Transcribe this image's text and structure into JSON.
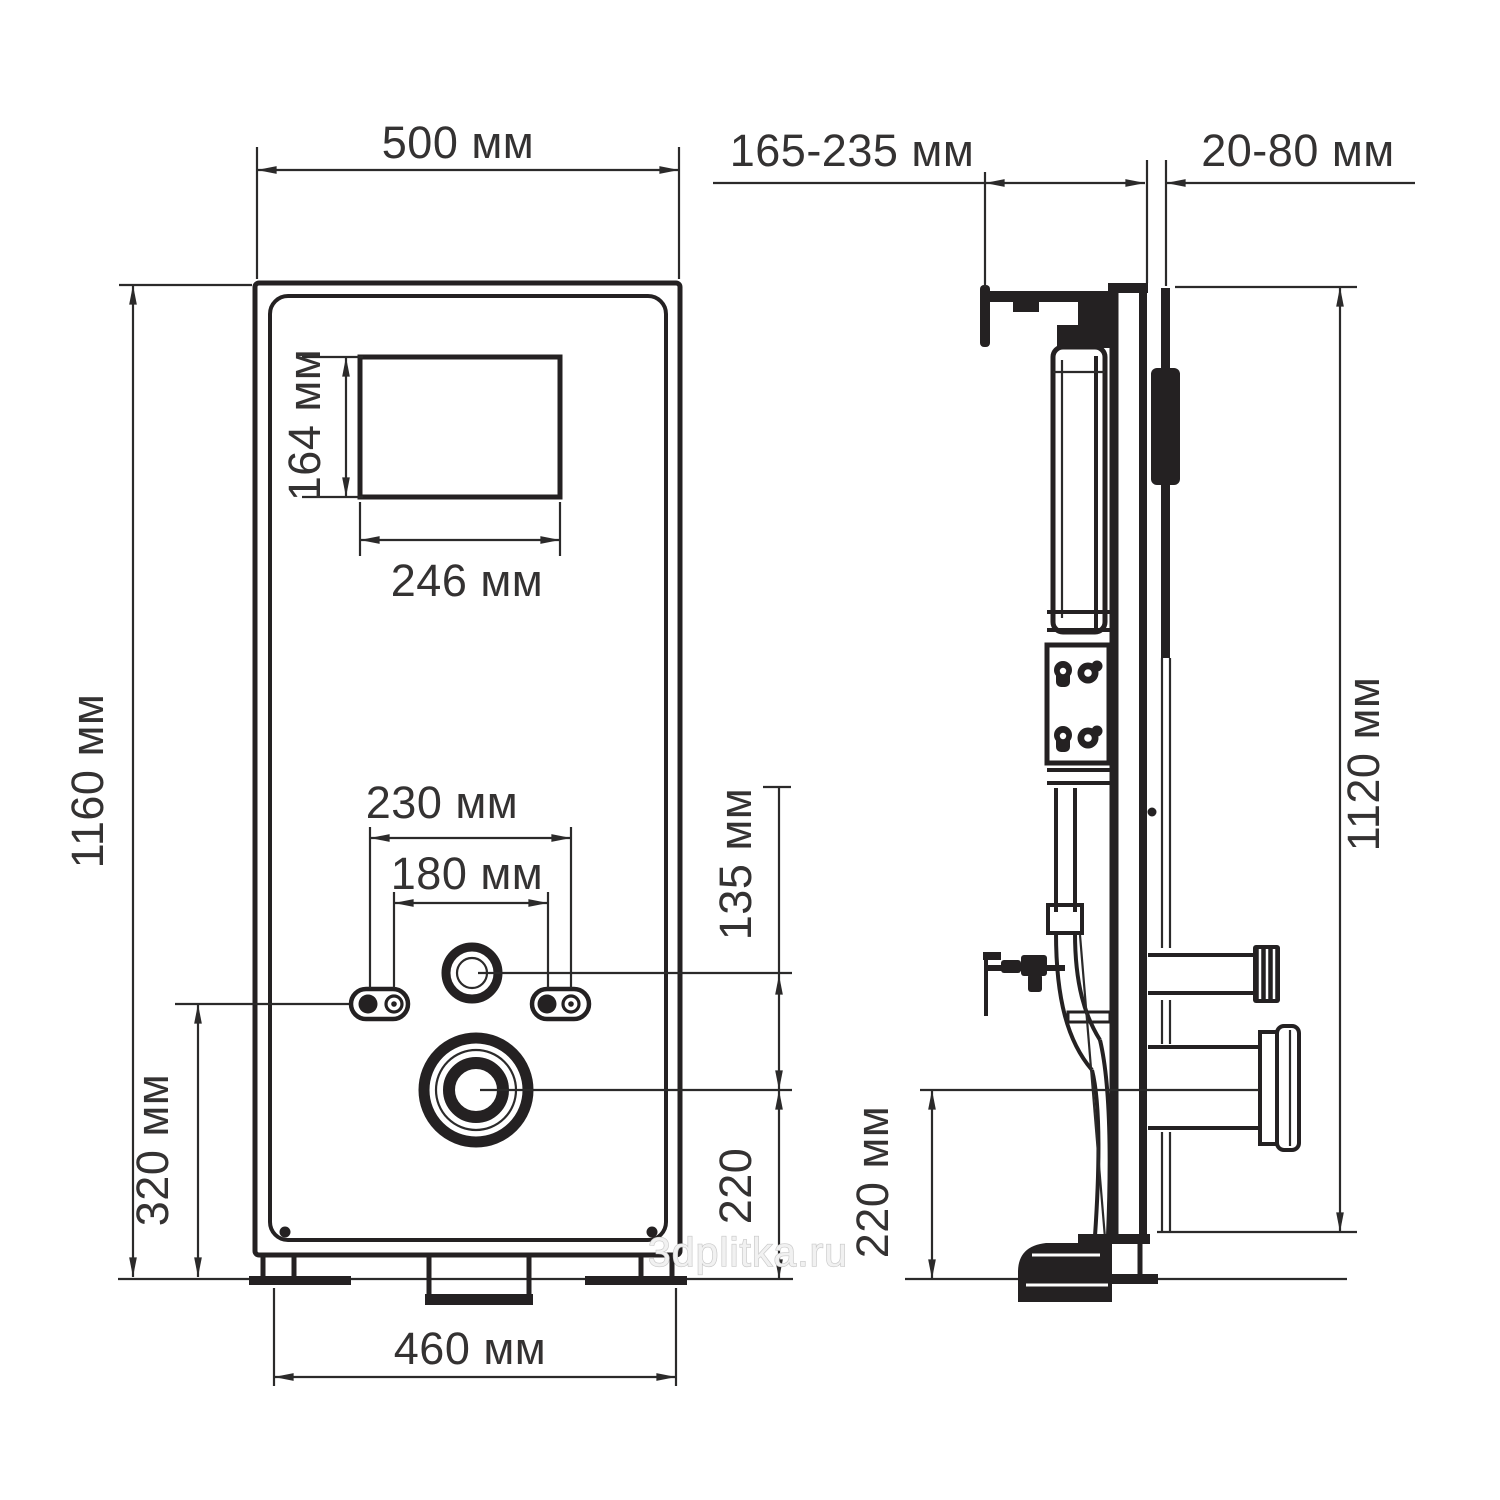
{
  "watermark": "3dplitka.ru",
  "front": {
    "width": "500 мм",
    "height": "1160 мм",
    "window_height": "164 мм",
    "window_width": "246 мм",
    "studs_outer": "230 мм",
    "studs_inner": "180 мм",
    "inlet_to_outlet": "135 мм",
    "outlet_to_floor": "220",
    "studs_to_floor": "320 мм",
    "feet_span": "460 мм"
  },
  "side": {
    "depth_adjust": "165-235 мм",
    "wall_finish": "20-80 мм",
    "height": "1120 мм",
    "outlet_to_floor": "220 мм"
  }
}
